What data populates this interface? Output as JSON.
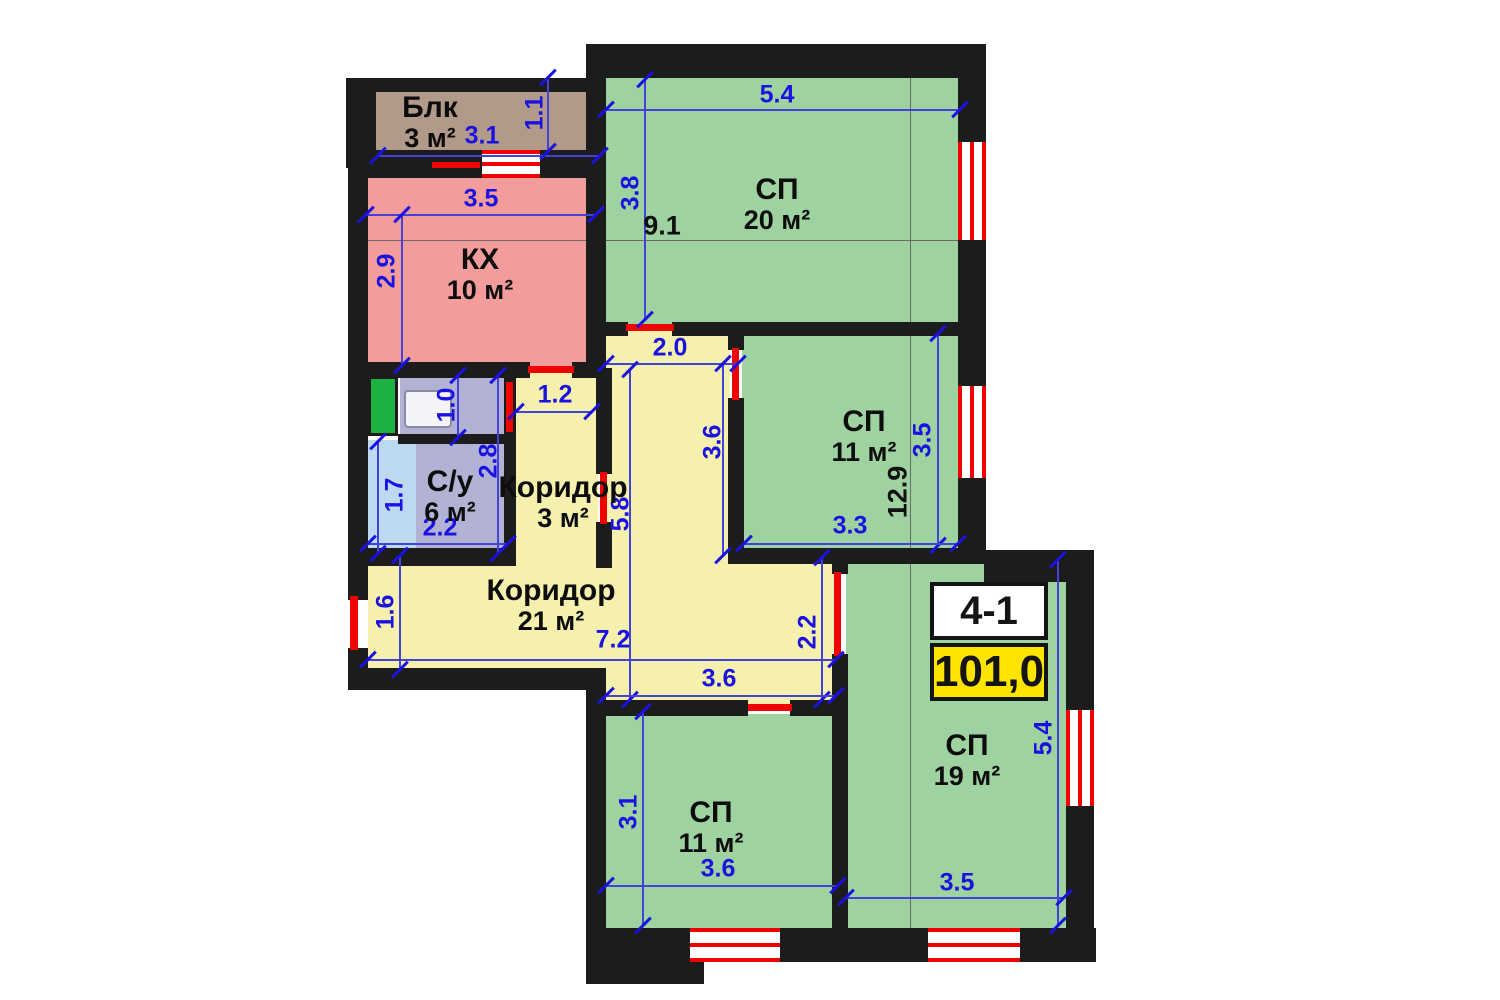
{
  "plan": {
    "unit_code": "4-1",
    "total_area": "101,0",
    "colors": {
      "wall": "#1c1c1c",
      "bedroom": "#9ed2a0",
      "corridor": "#f5f0ad",
      "kitchen": "#f29c9c",
      "balcony": "#b29a8b",
      "bathroom": "#b2b2d4",
      "tub": "#bdd9f1",
      "shaft": "#1db043",
      "door": "#ee0400",
      "window_stripe": "#f20000",
      "dim": "#1b12e2",
      "dim_line": "#4343d8",
      "ref_line": "#6a6a6a",
      "badge_yellow": "#ffe400"
    },
    "rooms": [
      {
        "id": "balcony",
        "label": "Блк",
        "area": "3 м²",
        "fill": "balcony",
        "rect": [
          368,
          88,
          232,
          76
        ],
        "label_cx": 430,
        "label_cy": 123
      },
      {
        "id": "kitchen",
        "label": "КХ",
        "area": "10 м²",
        "fill": "kitchen",
        "rect": [
          366,
          164,
          232,
          204
        ],
        "label_cx": 480,
        "label_cy": 275
      },
      {
        "id": "bedroom-20",
        "label": "СП",
        "area": "20 м²",
        "fill": "bedroom",
        "rect": [
          604,
          76,
          356,
          248
        ],
        "label_cx": 777,
        "label_cy": 205
      },
      {
        "id": "corridor-upper",
        "fill": "corridor",
        "rect": [
          602,
          324,
          128,
          240
        ]
      },
      {
        "id": "corridor-3",
        "label": "Коридор",
        "area": "3 м²",
        "fill": "corridor",
        "rect": [
          512,
          368,
          86,
          192
        ],
        "label_cx": 563,
        "label_cy": 503
      },
      {
        "id": "bathroom",
        "label": "С/у",
        "area": "6 м²",
        "fill": "bathroom",
        "rect": [
          366,
          440,
          140,
          112
        ],
        "label_cx": 450,
        "label_cy": 497
      },
      {
        "id": "bath-tub",
        "fill": "tub",
        "rect": [
          366,
          440,
          50,
          112
        ]
      },
      {
        "id": "closet",
        "fill": "bathroom",
        "rect": [
          400,
          374,
          106,
          62
        ]
      },
      {
        "id": "shaft",
        "fill": "shaft",
        "rect": [
          368,
          376,
          30,
          60
        ]
      },
      {
        "id": "corridor-21",
        "label": "Коридор",
        "area": "21 м²",
        "fill": "corridor",
        "rect": [
          368,
          556,
          466,
          116
        ],
        "label_cx": 551,
        "label_cy": 606
      },
      {
        "id": "corridor-21-lower",
        "fill": "corridor",
        "rect": [
          600,
          556,
          234,
          150
        ]
      },
      {
        "id": "bedroom-11-middle",
        "label": "СП",
        "area": "11 м²",
        "fill": "bedroom",
        "rect": [
          742,
          332,
          218,
          218
        ],
        "label_cx": 864,
        "label_cy": 437
      },
      {
        "id": "bedroom-11-bottom",
        "label": "СП",
        "area": "11 м²",
        "fill": "bedroom",
        "rect": [
          604,
          714,
          230,
          216
        ],
        "label_cx": 711,
        "label_cy": 828
      },
      {
        "id": "bedroom-19",
        "label": "СП",
        "area": "19 м²",
        "fill": "bedroom",
        "rect": [
          846,
          560,
          222,
          370
        ],
        "label_cx": 967,
        "label_cy": 761
      }
    ],
    "walls": [
      [
        588,
        44,
        398,
        34
      ],
      [
        348,
        78,
        252,
        14
      ],
      [
        346,
        78,
        30,
        90
      ],
      [
        356,
        150,
        128,
        28
      ],
      [
        540,
        150,
        66,
        28
      ],
      [
        348,
        164,
        20,
        216
      ],
      [
        348,
        362,
        182,
        16
      ],
      [
        572,
        362,
        34,
        16
      ],
      [
        348,
        376,
        20,
        184
      ],
      [
        348,
        556,
        20,
        44
      ],
      [
        348,
        648,
        20,
        42
      ],
      [
        348,
        668,
        256,
        22
      ],
      [
        586,
        668,
        20,
        270
      ],
      [
        586,
        928,
        118,
        56
      ],
      [
        586,
        44,
        20,
        328
      ],
      [
        596,
        368,
        16,
        106
      ],
      [
        596,
        522,
        16,
        46
      ],
      [
        604,
        322,
        24,
        14
      ],
      [
        672,
        322,
        292,
        14
      ],
      [
        398,
        434,
        110,
        10
      ],
      [
        504,
        376,
        12,
        182
      ],
      [
        728,
        330,
        16,
        20
      ],
      [
        728,
        398,
        16,
        156
      ],
      [
        728,
        548,
        258,
        16
      ],
      [
        984,
        550,
        110,
        32
      ],
      [
        958,
        44,
        28,
        98
      ],
      [
        958,
        240,
        28,
        146
      ],
      [
        958,
        478,
        28,
        80
      ],
      [
        832,
        556,
        16,
        18
      ],
      [
        832,
        654,
        16,
        278
      ],
      [
        586,
        700,
        162,
        16
      ],
      [
        790,
        700,
        58,
        16
      ],
      [
        1066,
        578,
        28,
        132
      ],
      [
        1066,
        806,
        28,
        124
      ],
      [
        586,
        928,
        104,
        34
      ],
      [
        780,
        928,
        148,
        34
      ],
      [
        1020,
        928,
        76,
        34
      ],
      [
        348,
        548,
        168,
        18
      ]
    ],
    "windows": [
      {
        "rect": [
          482,
          150,
          58,
          28
        ],
        "v": false
      },
      {
        "rect": [
          958,
          142,
          28,
          98
        ],
        "v": true
      },
      {
        "rect": [
          958,
          386,
          28,
          92
        ],
        "v": true
      },
      {
        "rect": [
          1066,
          710,
          28,
          96
        ],
        "v": true
      },
      {
        "rect": [
          690,
          928,
          90,
          34
        ],
        "v": false
      },
      {
        "rect": [
          928,
          928,
          92,
          34
        ],
        "v": false
      }
    ],
    "doors": [
      [
        350,
        596,
        8,
        54
      ],
      [
        528,
        366,
        46,
        7
      ],
      [
        626,
        324,
        48,
        7
      ],
      [
        732,
        348,
        7,
        52
      ],
      [
        600,
        472,
        7,
        52
      ],
      [
        506,
        382,
        7,
        50
      ],
      [
        748,
        704,
        44,
        7
      ],
      [
        834,
        572,
        7,
        84
      ],
      [
        432,
        162,
        48,
        6
      ]
    ],
    "fixture": {
      "rect": [
        404,
        390,
        48,
        38
      ]
    },
    "dimensions": [
      {
        "t": "3.1",
        "x": 482,
        "y": 136,
        "v": false,
        "line": [
          378,
          156,
          600,
          156
        ]
      },
      {
        "t": "1.1",
        "x": 535,
        "y": 113,
        "v": true,
        "line": [
          548,
          78,
          548,
          152
        ]
      },
      {
        "t": "3.5",
        "x": 481,
        "y": 199,
        "v": false,
        "line": [
          366,
          215,
          596,
          215
        ]
      },
      {
        "t": "2.9",
        "x": 387,
        "y": 271,
        "v": true,
        "line": [
          402,
          215,
          402,
          366
        ]
      },
      {
        "t": "5.4",
        "x": 777,
        "y": 95,
        "v": false,
        "line": [
          606,
          110,
          960,
          110
        ]
      },
      {
        "t": "3.8",
        "x": 631,
        "y": 193,
        "v": true,
        "line": [
          645,
          80,
          645,
          320
        ]
      },
      {
        "t": "2.0",
        "x": 670,
        "y": 348,
        "v": false,
        "line": [
          606,
          364,
          738,
          364
        ]
      },
      {
        "t": "3.6",
        "x": 713,
        "y": 442,
        "v": true,
        "line": [
          723,
          364,
          723,
          556
        ]
      },
      {
        "t": "5.8",
        "x": 621,
        "y": 514,
        "v": true,
        "line": [
          630,
          370,
          630,
          700
        ]
      },
      {
        "t": "1.2",
        "x": 555,
        "y": 395,
        "v": false,
        "line": [
          516,
          412,
          592,
          412
        ]
      },
      {
        "t": "1.0",
        "x": 447,
        "y": 405,
        "v": true,
        "line": [
          458,
          376,
          458,
          438
        ]
      },
      {
        "t": "2.8",
        "x": 489,
        "y": 461,
        "v": true,
        "line": [
          498,
          376,
          498,
          554
        ]
      },
      {
        "t": "1.7",
        "x": 395,
        "y": 495,
        "v": true,
        "line": [
          378,
          442,
          378,
          554
        ]
      },
      {
        "t": "2.2",
        "x": 440,
        "y": 528,
        "v": false,
        "line": [
          368,
          544,
          508,
          544
        ]
      },
      {
        "t": "3.5",
        "x": 923,
        "y": 440,
        "v": true,
        "line": [
          938,
          334,
          938,
          546
        ]
      },
      {
        "t": "3.3",
        "x": 850,
        "y": 526,
        "v": false,
        "line": [
          744,
          544,
          958,
          544
        ]
      },
      {
        "t": "1.6",
        "x": 386,
        "y": 612,
        "v": true,
        "line": [
          400,
          556,
          400,
          670
        ]
      },
      {
        "t": "7.2",
        "x": 613,
        "y": 640,
        "v": false,
        "line": [
          368,
          660,
          836,
          660
        ]
      },
      {
        "t": "2.2",
        "x": 808,
        "y": 632,
        "v": true,
        "line": [
          822,
          558,
          822,
          700
        ]
      },
      {
        "t": "3.6",
        "x": 719,
        "y": 679,
        "v": false,
        "line": [
          606,
          696,
          836,
          696
        ]
      },
      {
        "t": "3.1",
        "x": 629,
        "y": 812,
        "v": true,
        "line": [
          643,
          712,
          643,
          926
        ]
      },
      {
        "t": "3.6",
        "x": 718,
        "y": 869,
        "v": false,
        "line": [
          606,
          886,
          838,
          886
        ]
      },
      {
        "t": "5.4",
        "x": 1044,
        "y": 738,
        "v": true,
        "line": [
          1058,
          560,
          1058,
          926
        ]
      },
      {
        "t": "3.5",
        "x": 957,
        "y": 883,
        "v": false,
        "line": [
          846,
          898,
          1064,
          898
        ]
      }
    ],
    "overall_dims": [
      {
        "t": "9.1",
        "x": 662,
        "y": 226,
        "v": false
      },
      {
        "t": "12.9",
        "x": 898,
        "y": 492,
        "v": true
      }
    ],
    "ref_lines": [
      [
        350,
        240,
        958,
        240
      ],
      [
        910,
        48,
        910,
        928
      ]
    ]
  }
}
